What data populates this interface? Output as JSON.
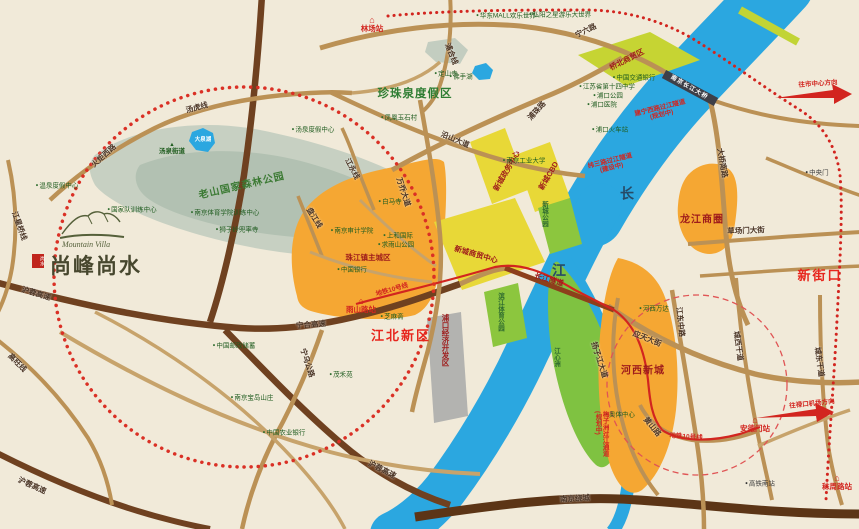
{
  "logo": {
    "en": "Mountain Villa",
    "cn": "尚峰尚水",
    "seal": "尚水"
  },
  "icons": {
    "dot": "●",
    "triangle": "▲",
    "station": "⌂"
  },
  "colors": {
    "background": "#f1ead9",
    "river": "#2ba7e0",
    "forest": "#b2c1b2",
    "district_orange": "#f5a733",
    "park_green": "#7fc241",
    "cbd_yellow": "#e8d837",
    "trade_yellowgreen": "#c6d433",
    "industry_gray": "#b3b3b0",
    "expressway_brown": "#6f4120",
    "road_tan": "#bb9155",
    "metro_red": "#d2251f",
    "circle_red": "#da3025",
    "region_red": "#e7261d",
    "region_darkred": "#9e1b1b",
    "area_green_text": "#2e7d32"
  },
  "labels": [
    {
      "name": "road-ningliulu",
      "text": "宁六路",
      "x": 586,
      "y": 31,
      "cls": "road",
      "rot": -26
    },
    {
      "name": "road-puzhulu",
      "text": "浦珠路",
      "x": 537,
      "y": 111,
      "cls": "road",
      "rot": -48
    },
    {
      "name": "road-yanshandadao",
      "text": "沿山大道",
      "x": 455,
      "y": 140,
      "cls": "road",
      "rot": 23
    },
    {
      "name": "road-puhexian",
      "text": "浦合线",
      "x": 451,
      "y": 54,
      "cls": "road",
      "rot": 68
    },
    {
      "name": "road-tanghuxian",
      "text": "汤虎线",
      "x": 197,
      "y": 108,
      "cls": "road",
      "rot": -15
    },
    {
      "name": "road-huojuxilu",
      "text": "火炬西路",
      "x": 104,
      "y": 156,
      "cls": "road",
      "rot": -42
    },
    {
      "name": "road-jiangxingqiaoxian",
      "text": "江星桥线",
      "x": 19,
      "y": 226,
      "cls": "road",
      "rot": 70
    },
    {
      "name": "road-gaowangxian",
      "text": "高旺线",
      "x": 17,
      "y": 363,
      "cls": "road",
      "rot": 45
    },
    {
      "name": "road-hurong-1",
      "text": "沪蓉高速",
      "x": 36,
      "y": 294,
      "cls": "road",
      "rot": 17
    },
    {
      "name": "road-hurong-2",
      "text": "沪蓉高速",
      "x": 382,
      "y": 470,
      "cls": "road",
      "rot": 27
    },
    {
      "name": "road-hurong-3",
      "text": "沪蓉高速",
      "x": 32,
      "y": 486,
      "cls": "road",
      "rot": 24
    },
    {
      "name": "road-ninghe-expwy",
      "text": "宁合高速",
      "x": 311,
      "y": 325,
      "cls": "road",
      "rot": -4
    },
    {
      "name": "road-ningwu",
      "text": "宁乌公路",
      "x": 307,
      "y": 363,
      "cls": "road",
      "rot": 72
    },
    {
      "name": "road-wanqiaodadao",
      "text": "万乔大道",
      "x": 403,
      "y": 192,
      "cls": "road",
      "rot": 72
    },
    {
      "name": "road-jiangyongxian",
      "text": "江永线",
      "x": 352,
      "y": 169,
      "cls": "road",
      "rot": 62
    },
    {
      "name": "road-panjiangxian",
      "text": "盘江线",
      "x": 314,
      "y": 218,
      "cls": "road",
      "rot": 58
    },
    {
      "name": "road-daqiaonanlu",
      "text": "大桥南路",
      "x": 722,
      "y": 163,
      "cls": "road",
      "rot": 80
    },
    {
      "name": "road-yingtiandajie",
      "text": "应天大街",
      "x": 647,
      "y": 339,
      "cls": "road",
      "rot": 22
    },
    {
      "name": "road-jiangdongzhonglu",
      "text": "江东中路",
      "x": 680,
      "y": 322,
      "cls": "road",
      "rot": 84
    },
    {
      "name": "road-chengxigandao",
      "text": "城西干道",
      "x": 738,
      "y": 346,
      "cls": "road",
      "rot": 82
    },
    {
      "name": "road-chengdonggandao",
      "text": "城东干道",
      "x": 819,
      "y": 362,
      "cls": "road",
      "rot": 82
    },
    {
      "name": "road-caochangmendajie",
      "text": "草场门大街",
      "x": 746,
      "y": 231,
      "cls": "road",
      "rot": -2
    },
    {
      "name": "road-yangzijiangdadao",
      "text": "扬子江大道",
      "x": 599,
      "y": 360,
      "cls": "road",
      "rot": 72
    },
    {
      "name": "road-huangshanlu",
      "text": "黄山路",
      "x": 652,
      "y": 427,
      "cls": "road",
      "rot": 50
    },
    {
      "name": "road-nanjingraocheng",
      "text": "南京绕城",
      "x": 575,
      "y": 499,
      "cls": "road",
      "rot": -3
    },
    {
      "name": "tunnel-changjiang",
      "text": "长江隧道",
      "x": 549,
      "y": 280,
      "cls": "darkred-sm",
      "rot": 16
    },
    {
      "name": "region-zhenzhuquan",
      "text": "珍珠泉度假区",
      "x": 415,
      "y": 94,
      "cls": "green-big"
    },
    {
      "name": "region-laoshan-park",
      "text": "老山国家森林公园",
      "x": 242,
      "y": 187,
      "cls": "green-mid",
      "rot": -13
    },
    {
      "name": "region-qiaobei",
      "text": "桥北商贸区",
      "x": 627,
      "y": 60,
      "cls": "darkred-sm",
      "rot": -27
    },
    {
      "name": "region-xincheng-zhengwu",
      "text": "新城政务中心",
      "x": 507,
      "y": 171,
      "cls": "darkred-sm",
      "rot": -60
    },
    {
      "name": "region-xincheng-cbd",
      "text": "新城CBD",
      "x": 549,
      "y": 176,
      "cls": "darkred-sm",
      "rot": -60
    },
    {
      "name": "region-xincheng-shangmao",
      "text": "新城商贸中心",
      "x": 476,
      "y": 255,
      "cls": "darkred-sm",
      "rot": 16
    },
    {
      "name": "region-zhujiangzhen",
      "text": "珠江镇主城区",
      "x": 368,
      "y": 258,
      "cls": "darkred-sm"
    },
    {
      "name": "region-jiangbei-xinqu",
      "text": "江北新区",
      "x": 401,
      "y": 336,
      "cls": "red-big"
    },
    {
      "name": "region-longjiang",
      "text": "龙江商圈",
      "x": 702,
      "y": 221,
      "cls": "darkred"
    },
    {
      "name": "region-hexi-xincheng",
      "text": "河西新城",
      "x": 643,
      "y": 372,
      "cls": "darkred"
    },
    {
      "name": "region-xinjiekou",
      "text": "新街口",
      "x": 820,
      "y": 276,
      "cls": "red-big"
    },
    {
      "name": "region-pukou-jingji",
      "text": "浦口经济开发区",
      "x": 445,
      "y": 340,
      "cls": "darkred-sm vertical"
    },
    {
      "name": "park-binjiang",
      "text": "滨江体育公园",
      "x": 500,
      "y": 312,
      "cls": "green-strip vertical"
    },
    {
      "name": "park-xincheng",
      "text": "新城公园",
      "x": 544,
      "y": 214,
      "cls": "green-strip vertical"
    },
    {
      "name": "island-jiangxinzhou",
      "text": "江心洲",
      "x": 556,
      "y": 357,
      "cls": "green-strip vertical"
    },
    {
      "name": "river-char-chang",
      "text": "长",
      "x": 627,
      "y": 194,
      "cls": "river-ch"
    },
    {
      "name": "river-char-jiang",
      "text": "江",
      "x": 559,
      "y": 271,
      "cls": "river-ch"
    },
    {
      "name": "poi-huadong-mall",
      "text": "华东MALL欢乐世界",
      "x": 506,
      "y": 16,
      "cls": "poi",
      "icon": "dot"
    },
    {
      "name": "poi-hongyang",
      "text": "弘阳之星游乐大世界",
      "x": 560,
      "y": 15,
      "cls": "poi",
      "icon": "dot"
    },
    {
      "name": "poi-dingshansi",
      "text": "定山寺",
      "x": 446,
      "y": 74,
      "cls": "poi",
      "icon": "dot"
    },
    {
      "name": "poi-foshouhu",
      "text": "佛手湖",
      "x": 461,
      "y": 77,
      "cls": "poi",
      "icon": "dot"
    },
    {
      "name": "poi-yushicun",
      "text": "凤凰玉石村",
      "x": 399,
      "y": 118,
      "cls": "poi",
      "icon": "dot"
    },
    {
      "name": "poi-tangquan-dujia",
      "text": "汤泉度假中心",
      "x": 313,
      "y": 130,
      "cls": "poi",
      "icon": "dot"
    },
    {
      "name": "poi-wenquan-dujia",
      "text": "温泉度假中心",
      "x": 57,
      "y": 186,
      "cls": "poi",
      "icon": "dot"
    },
    {
      "name": "poi-guojiadui",
      "text": "国家队训练中心",
      "x": 132,
      "y": 210,
      "cls": "poi",
      "icon": "dot"
    },
    {
      "name": "poi-tiyuxueyuan",
      "text": "南京体育学院训练中心",
      "x": 225,
      "y": 213,
      "cls": "poi",
      "icon": "dot"
    },
    {
      "name": "poi-shiziling",
      "text": "狮子岭兜率寺",
      "x": 237,
      "y": 230,
      "cls": "poi",
      "icon": "dot"
    },
    {
      "name": "poi-baimasi",
      "text": "白马寺",
      "x": 390,
      "y": 202,
      "cls": "poi",
      "icon": "dot"
    },
    {
      "name": "poi-shenji-xueyuan",
      "text": "南京审计学院",
      "x": 352,
      "y": 231,
      "cls": "poi",
      "icon": "dot"
    },
    {
      "name": "poi-shanghe-guoji",
      "text": "上和国际",
      "x": 398,
      "y": 236,
      "cls": "poi",
      "icon": "dot"
    },
    {
      "name": "poi-qiuyushan-park",
      "text": "求雨山公园",
      "x": 396,
      "y": 245,
      "cls": "poi",
      "icon": "dot"
    },
    {
      "name": "poi-zhongguo-yinhang",
      "text": "中国银行",
      "x": 352,
      "y": 270,
      "cls": "poi",
      "icon": "dot"
    },
    {
      "name": "poi-nanjing-gongye-daxue",
      "text": "南京工业大学",
      "x": 524,
      "y": 161,
      "cls": "poi",
      "icon": "dot"
    },
    {
      "name": "poi-jiaotong-yinhang",
      "text": "中国交通银行",
      "x": 634,
      "y": 78,
      "cls": "poi",
      "icon": "dot"
    },
    {
      "name": "poi-shisi-zhongxue",
      "text": "江苏省第十四中学",
      "x": 607,
      "y": 87,
      "cls": "poi",
      "icon": "dot"
    },
    {
      "name": "poi-pukou-gongyuan",
      "text": "浦口公园",
      "x": 608,
      "y": 96,
      "cls": "poi",
      "icon": "dot"
    },
    {
      "name": "poi-pukou-yiyuan",
      "text": "浦口医院",
      "x": 602,
      "y": 105,
      "cls": "poi",
      "icon": "dot"
    },
    {
      "name": "poi-pukou-huochezhan",
      "text": "浦口火车站",
      "x": 610,
      "y": 130,
      "cls": "poi",
      "icon": "dot"
    },
    {
      "name": "poi-hexi-wanda",
      "text": "河西万达",
      "x": 654,
      "y": 309,
      "cls": "poi",
      "icon": "dot"
    },
    {
      "name": "poi-aoti-zhongxin",
      "text": "奥体中心",
      "x": 620,
      "y": 415,
      "cls": "poi",
      "icon": "dot"
    },
    {
      "name": "poi-zhongyangmen",
      "text": "中央门",
      "x": 817,
      "y": 173,
      "cls": "poi-dark",
      "icon": "dot"
    },
    {
      "name": "poi-gaotienanzhan",
      "text": "高铁南站",
      "x": 760,
      "y": 484,
      "cls": "poi-dark",
      "icon": "dot"
    },
    {
      "name": "poi-youzheng-chuxu",
      "text": "中国邮政储蓄",
      "x": 234,
      "y": 346,
      "cls": "poi",
      "icon": "dot"
    },
    {
      "name": "poi-baodao-shanzhuang",
      "text": "南京宝岛山庄",
      "x": 252,
      "y": 398,
      "cls": "poi",
      "icon": "dot"
    },
    {
      "name": "poi-nongye-yinhang",
      "text": "中国农业银行",
      "x": 284,
      "y": 433,
      "cls": "poi",
      "icon": "dot"
    },
    {
      "name": "poi-maoheyuan",
      "text": "茂禾苑",
      "x": 341,
      "y": 375,
      "cls": "poi",
      "icon": "dot"
    },
    {
      "name": "poi-zhimazhai",
      "text": "芝麻斋",
      "x": 392,
      "y": 317,
      "cls": "poi",
      "icon": "dot"
    },
    {
      "name": "town-tangquan-jiedao",
      "text": "汤泉街道",
      "x": 172,
      "y": 149,
      "cls": "town",
      "icon": "triangle"
    },
    {
      "name": "station-linchang",
      "text": "林场站",
      "x": 372,
      "y": 24,
      "cls": "station",
      "icon": "station"
    },
    {
      "name": "station-yushanlu",
      "text": "雨山路站",
      "x": 361,
      "y": 305,
      "cls": "station",
      "icon": "station"
    },
    {
      "name": "station-andemen",
      "text": "安德门站",
      "x": 755,
      "y": 424,
      "cls": "station",
      "icon": "station"
    },
    {
      "name": "station-mozhoulu",
      "text": "秣周路站",
      "x": 837,
      "y": 482,
      "cls": "station",
      "icon": "station"
    },
    {
      "name": "metro-line10-west",
      "text": "地铁10号线",
      "x": 392,
      "y": 290,
      "cls": "metro",
      "rot": -16
    },
    {
      "name": "metro-line10-east",
      "text": "地铁10号线",
      "x": 686,
      "y": 437,
      "cls": "metro",
      "rot": 4
    },
    {
      "name": "crossing-jianning",
      "text": "建宁西路过江隧道(规划中)",
      "x": 661,
      "y": 112,
      "cls": "metro wrap",
      "rot": -14,
      "w": 56
    },
    {
      "name": "crossing-weisan",
      "text": "纬三路过江隧道(建设中)",
      "x": 611,
      "y": 165,
      "cls": "metro wrap",
      "rot": -14,
      "w": 52
    },
    {
      "name": "crossing-meizizhou",
      "text": "梅子洲过江通道(规划中)",
      "x": 601,
      "y": 437,
      "cls": "metro vert-wrap"
    },
    {
      "name": "arrow-label-city",
      "text": "往市中心方向",
      "x": 818,
      "y": 84,
      "cls": "arrowtxt",
      "rot": -4
    },
    {
      "name": "arrow-label-airport",
      "text": "往禄口机场方向",
      "x": 812,
      "y": 404,
      "cls": "arrowtxt",
      "rot": -6
    },
    {
      "name": "bridge-changjiang-daqiao",
      "text": "南京长江大桥",
      "x": 689,
      "y": 88,
      "cls": "bridge-t",
      "rot": 30
    },
    {
      "name": "lake-daquanhu",
      "text": "大泉湖",
      "x": 203,
      "y": 141,
      "cls": "lake"
    }
  ]
}
